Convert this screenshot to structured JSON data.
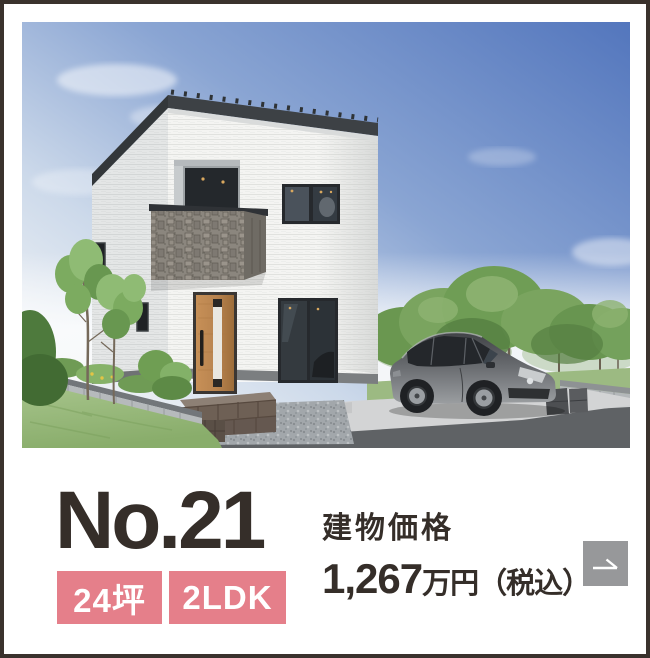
{
  "listing": {
    "number": "No.21",
    "tags": [
      {
        "label": "24坪"
      },
      {
        "label": "2LDK"
      }
    ],
    "price": {
      "label": "建物価格",
      "value": "1,267",
      "unit": "万円（税込）"
    }
  },
  "icons": {
    "arrow_button": "diagonal-arrow-right"
  },
  "colors": {
    "badge_pink": "#e57f8a",
    "text_dark": "#352e29",
    "arrow_button_gray": "#97989a",
    "card_border": "#3a322d",
    "sky_blue": "#5376bd",
    "lawn_green": "#97ba7b",
    "door_wood": "#b8834f"
  }
}
